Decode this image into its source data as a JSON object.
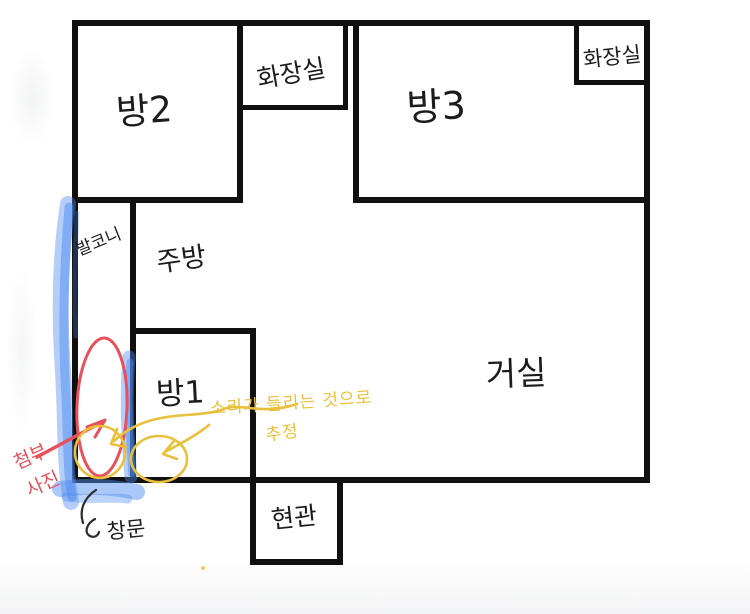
{
  "colors": {
    "wall": "#101010",
    "marker_blue": "#4e8bf0",
    "annotation_red": "#e8505c",
    "annotation_yellow": "#e9c03c",
    "arrow_black": "#2b2b2b",
    "background": "#ffffff"
  },
  "rooms": {
    "room2": {
      "label": "방2"
    },
    "bathroom_top": {
      "label": "화장실"
    },
    "room3": {
      "label": "방3"
    },
    "bathroom_corner": {
      "label": "화장실"
    },
    "balcony": {
      "label": "발코니"
    },
    "kitchen": {
      "label": "주방"
    },
    "room1": {
      "label": "방1"
    },
    "living_room": {
      "label": "거실"
    },
    "entrance": {
      "label": "현관"
    }
  },
  "annotations": {
    "attached_photo_note": {
      "line1": "첨부",
      "line2": "사진"
    },
    "sound_note": {
      "line1": "소리가 들리는 것으로",
      "line2": "추정"
    },
    "window_note": {
      "label": "창문"
    }
  }
}
